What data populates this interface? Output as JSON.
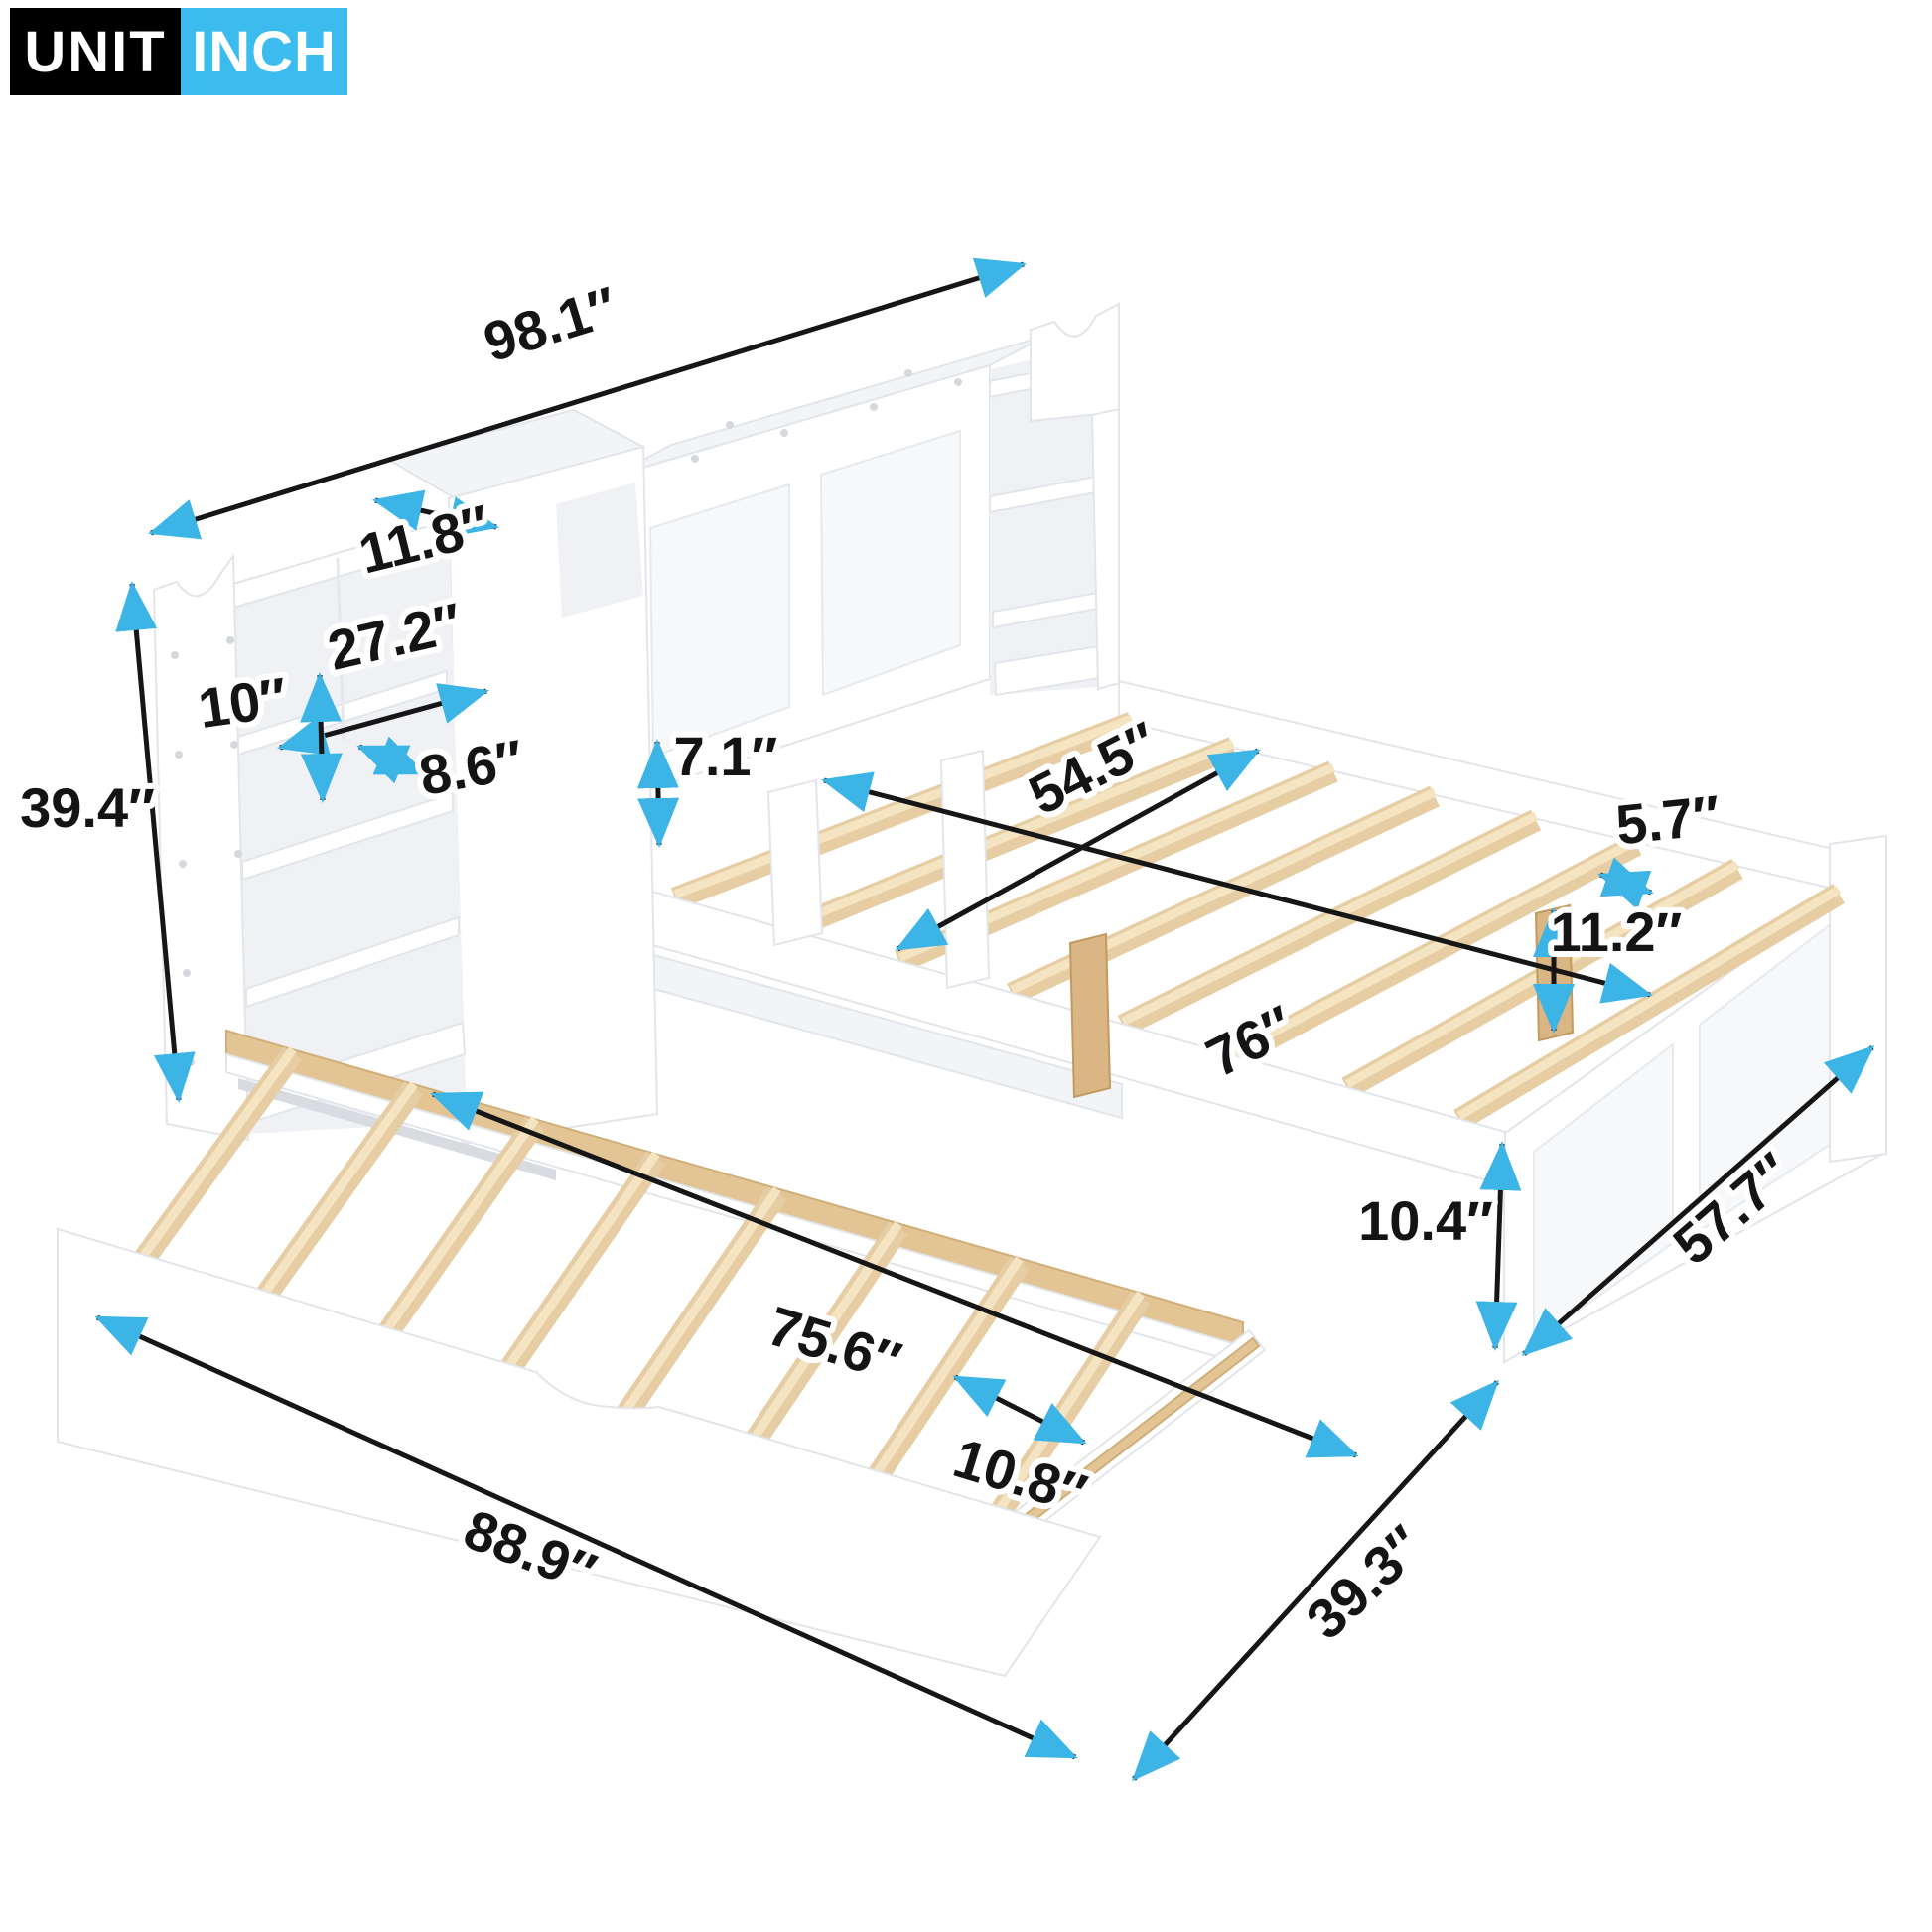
{
  "badge": {
    "unit_label": "UNIT",
    "unit_value": "INCH"
  },
  "colors": {
    "accent_arrow": "#3cb5e6",
    "dimension_line": "#161616",
    "badge_black": "#000000",
    "badge_blue": "#3cbcee",
    "wood_slat": "#e6cda3",
    "furniture": "#ffffff"
  },
  "dimensions": {
    "overall_width": "98.1″",
    "headboard_top_depth": "11.8″",
    "shelf_opening_width": "27.2″",
    "shelf_opening_height": "10″",
    "shelf_depth": "8.6″",
    "headboard_height": "39.4″",
    "platform_clearance": "7.1″",
    "bed_width": "54.5″",
    "bed_length": "76″",
    "slat_gap": "5.7″",
    "under_bed_clearance": "11.2″",
    "side_rail_height": "10.4″",
    "foot_side_width": "57.7″",
    "trundle_length": "75.6″",
    "trundle_slat_gap": "10.8″",
    "overall_pulled_width": "88.9″",
    "trundle_depth": "39.3″"
  }
}
